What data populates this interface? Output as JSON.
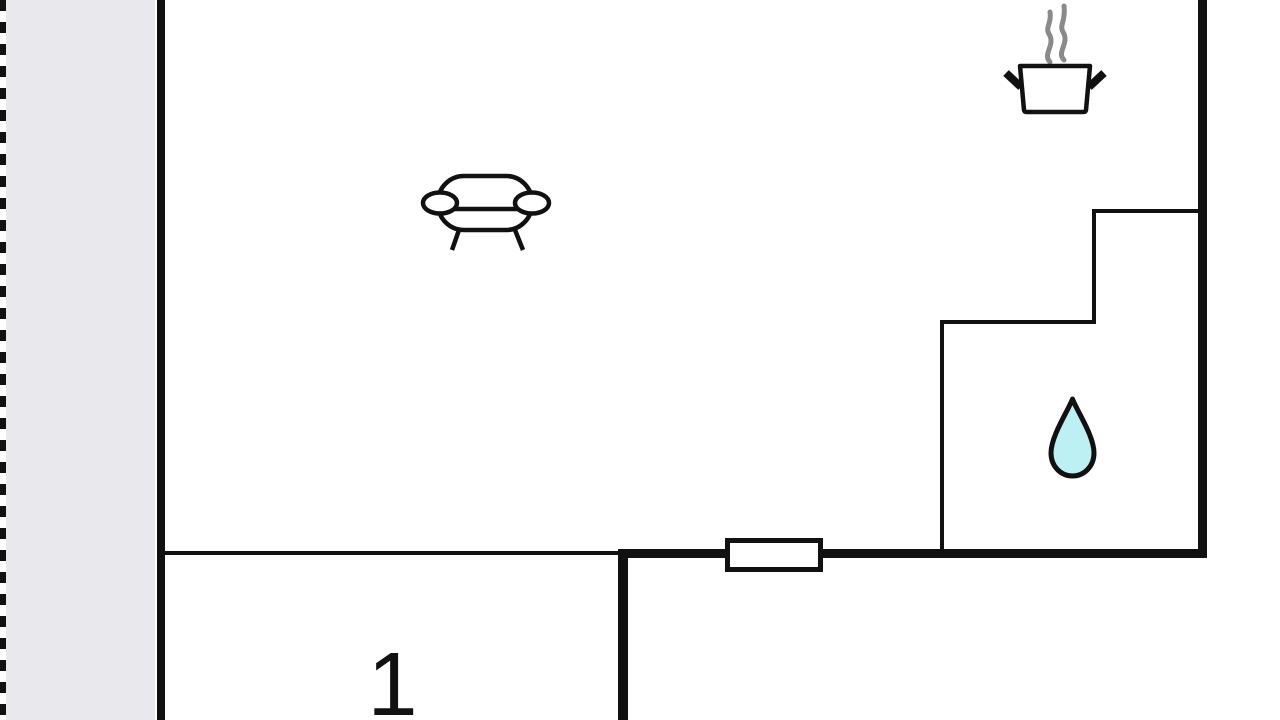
{
  "floorplan": {
    "room_label": "1",
    "colors": {
      "wall": "#111111",
      "terrace_fill": "#e9e8ec",
      "steam": "#8a8a8a",
      "water_drop_fill": "#bdf0f2",
      "background": "#ffffff"
    },
    "icons": {
      "sofa": "sofa-icon",
      "cooking_pot": "cooking-pot-icon",
      "steam": "steam-icon",
      "water_drop": "water-drop-icon"
    }
  }
}
